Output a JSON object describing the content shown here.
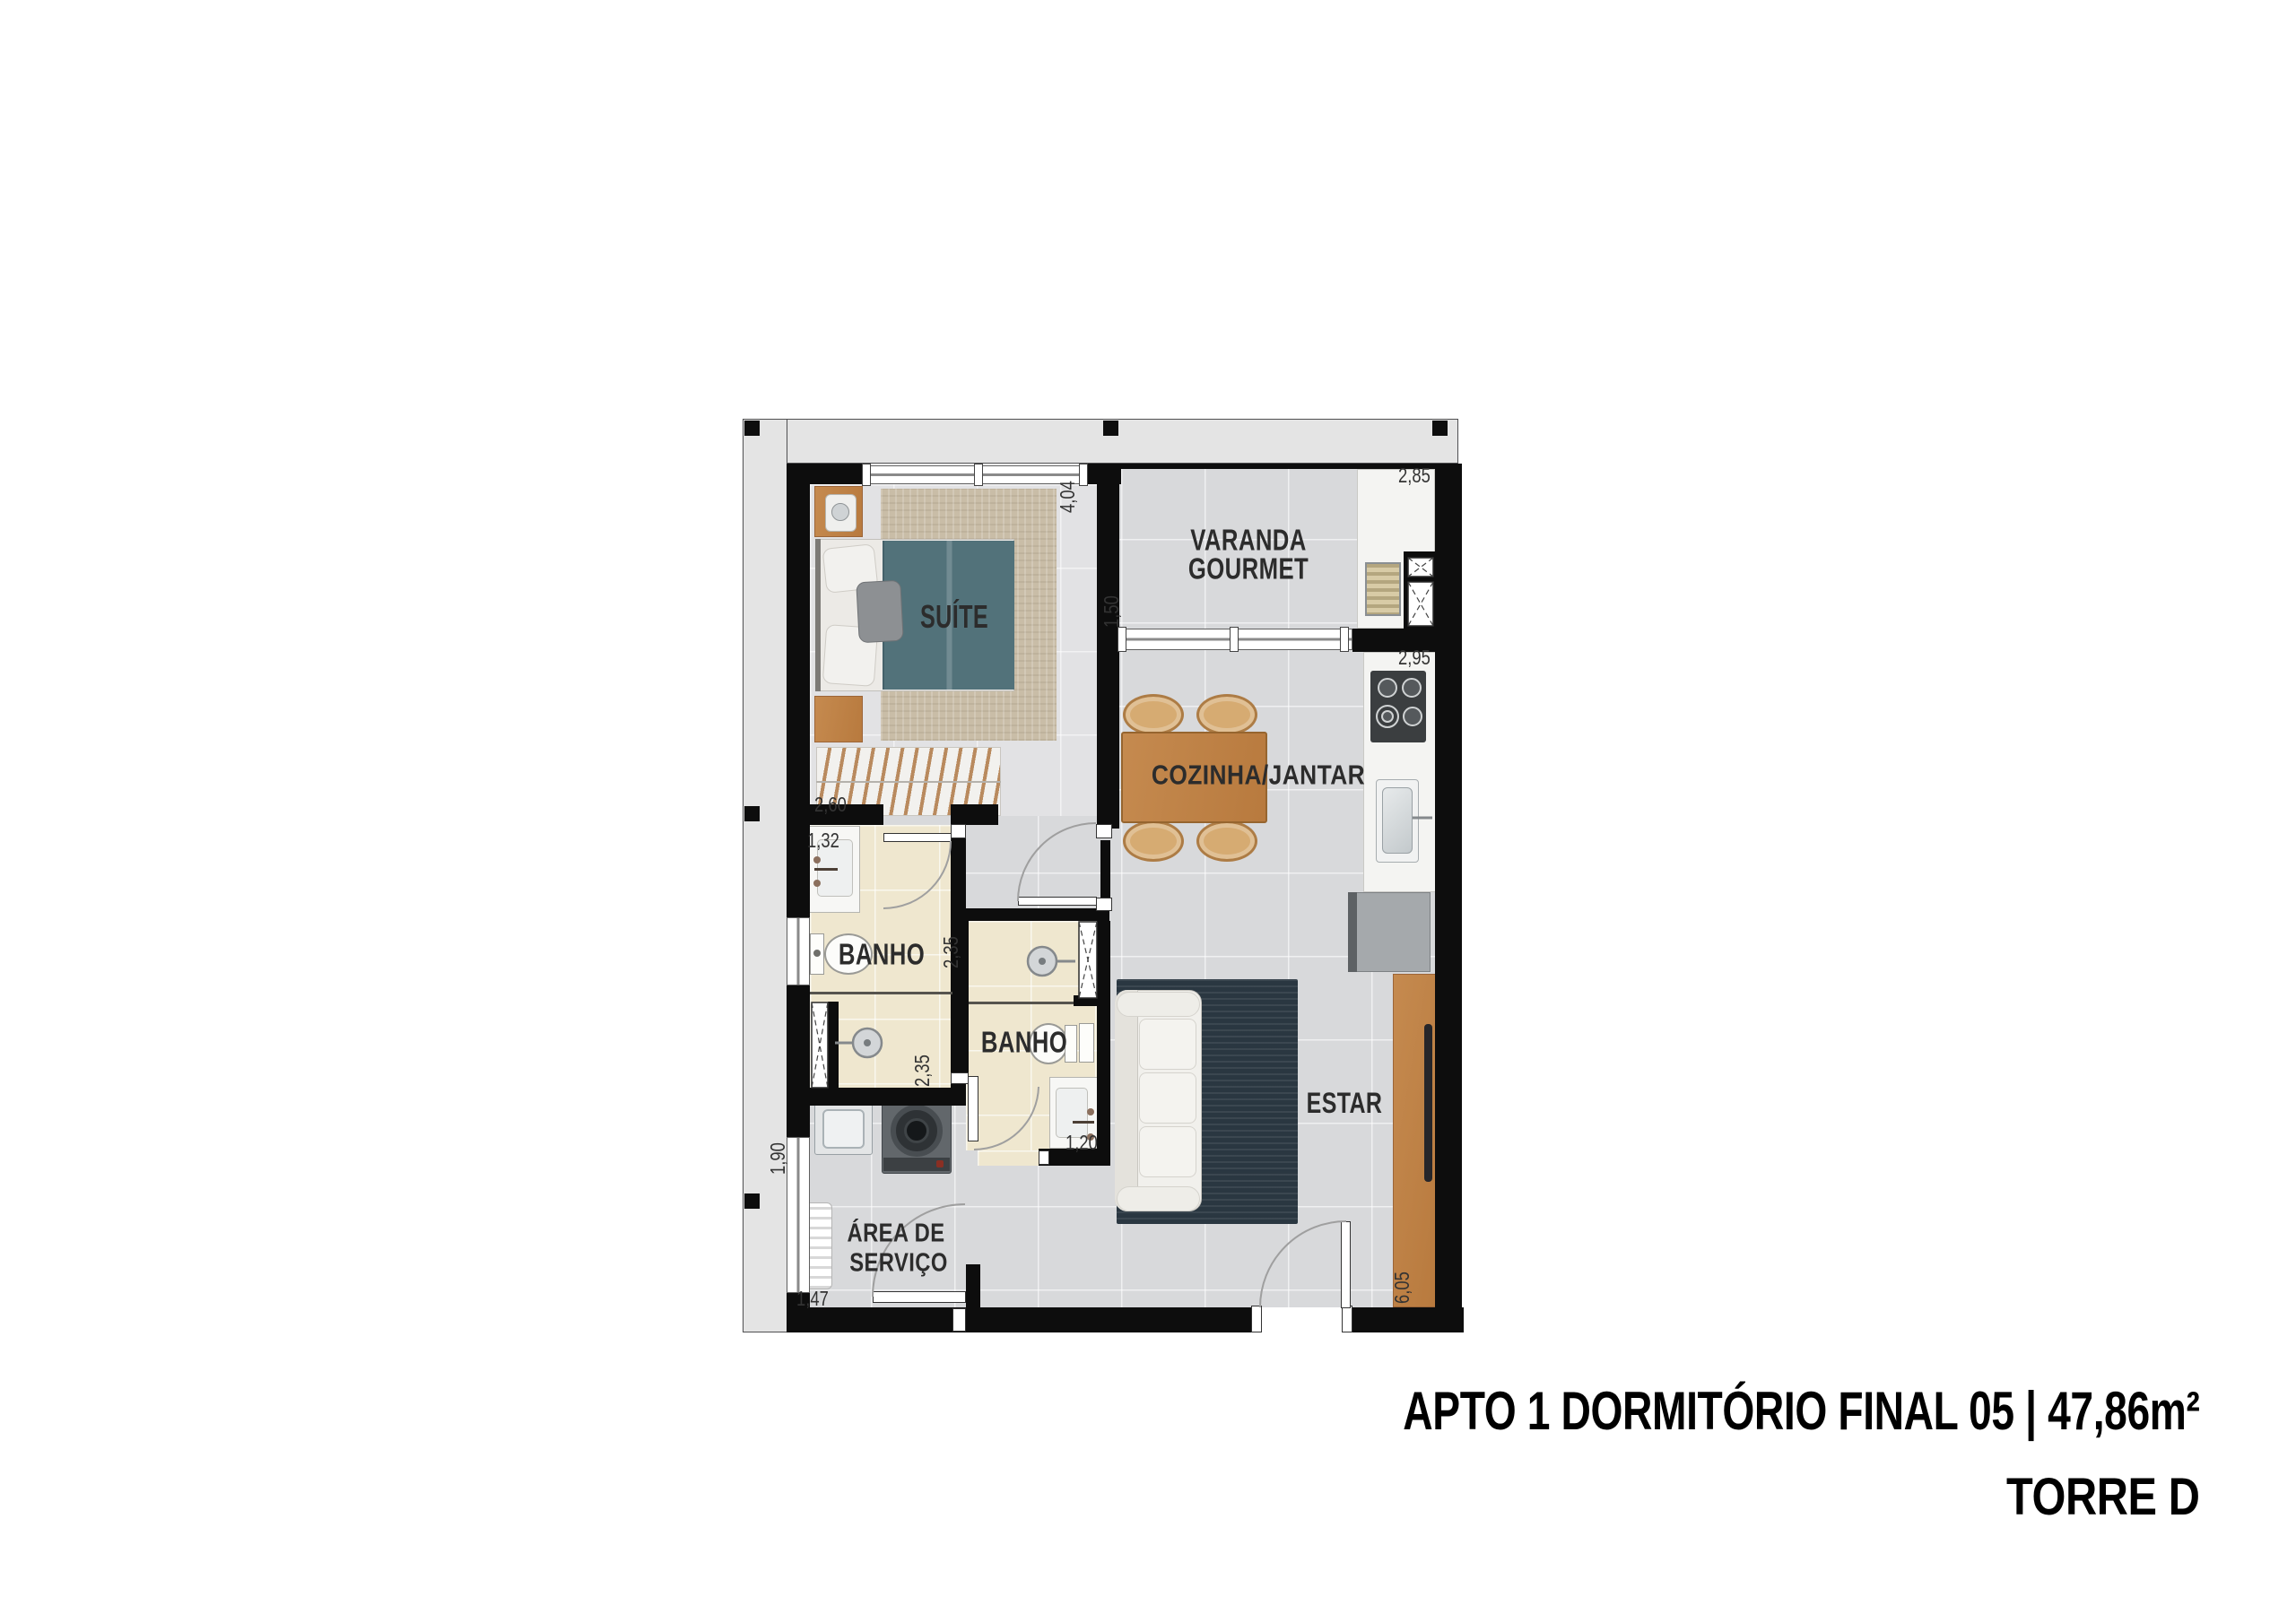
{
  "plan": {
    "labels": {
      "suite": "SUÍTE",
      "varanda1": "VARANDA",
      "varanda2": "GOURMET",
      "cozinha": "COZINHA/JANTAR",
      "banho_suite": "BANHO",
      "banho_social": "BANHO",
      "estar": "ESTAR",
      "servico1": "ÁREA DE",
      "servico2": "SERVIÇO"
    },
    "dims": {
      "varanda_w": "2,85",
      "cozinha_w": "2,95",
      "suite_d": "4,04",
      "varanda_d": "1,50",
      "closet_w": "2,60",
      "banho_suite_w": "1,32",
      "banho_suite_d": "2,35",
      "banho_social_d": "2,35",
      "banho_social_w": "1,20",
      "servico_d": "1,90",
      "servico_w": "1,47",
      "estar_d": "6,05"
    },
    "colors": {
      "wall": "#0d0d0d",
      "floor": "#d8d9db",
      "bath_floor": "#efe7cf",
      "wood": "#c08348",
      "bed_cover": "#52727a",
      "estar_rug": "#2a3741",
      "suite_rug": "#c9bda7"
    }
  },
  "title": {
    "apto": "APTO 1 DORMITÓRIO FINAL 05 | 47,86m²",
    "torre": "TORRE D"
  }
}
